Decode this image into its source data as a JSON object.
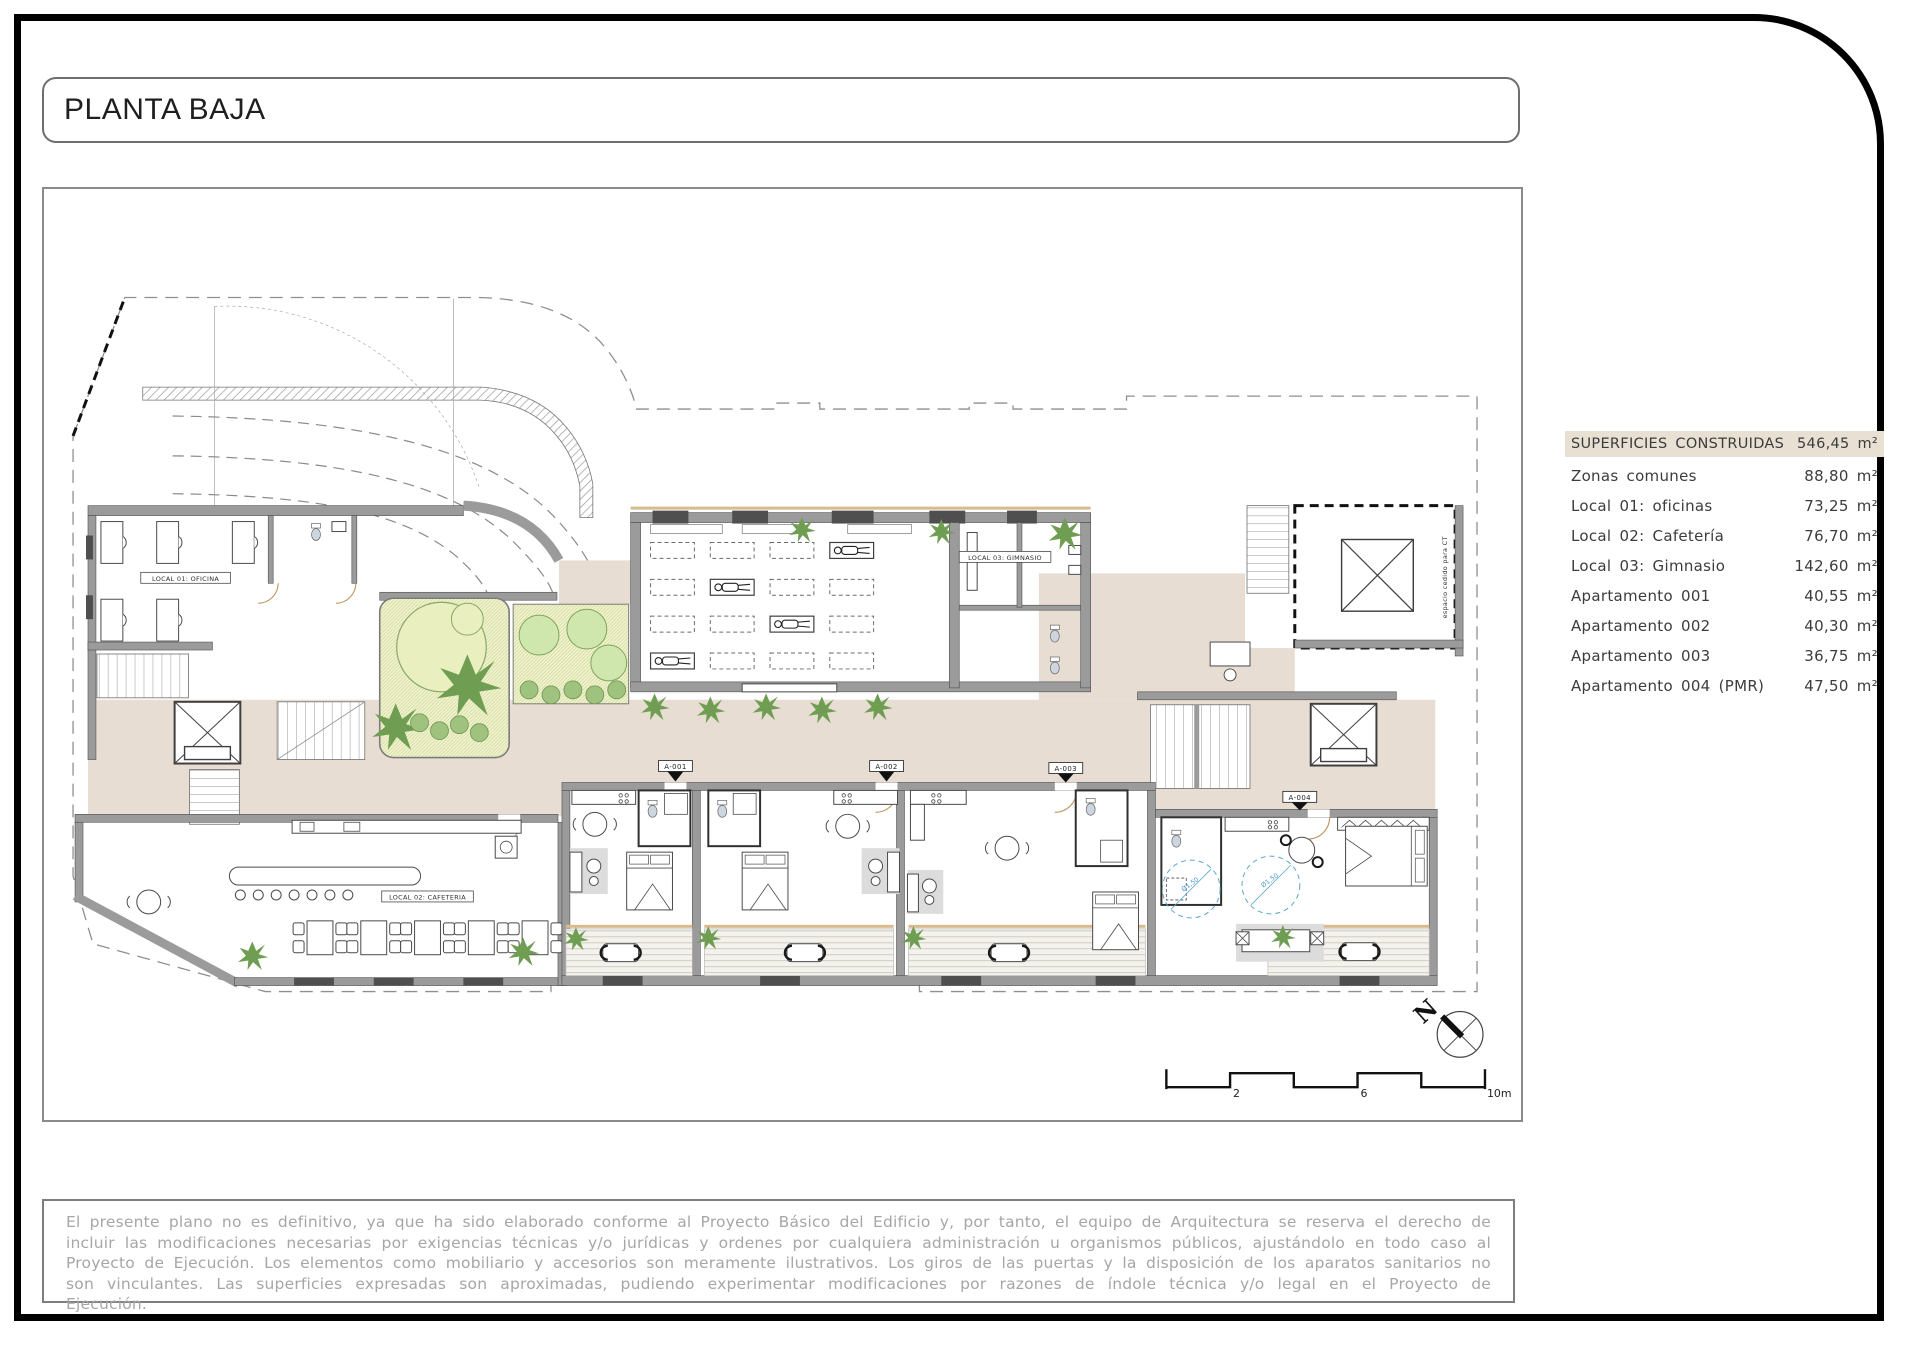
{
  "page": {
    "title": "PLANTA BAJA"
  },
  "areas_table": {
    "header": {
      "label": "SUPERFICIES CONSTRUIDAS",
      "value": "546,45 m²"
    },
    "rows": [
      {
        "label": "Zonas comunes",
        "value": "88,80 m²"
      },
      {
        "label": "Local 01: oficinas",
        "value": "73,25 m²"
      },
      {
        "label": "Local 02: Cafetería",
        "value": "76,70 m²"
      },
      {
        "label": "Local 03: Gimnasio",
        "value": "142,60 m²"
      },
      {
        "label": "Apartamento 001",
        "value": "40,55 m²"
      },
      {
        "label": "Apartamento 002",
        "value": "40,30 m²"
      },
      {
        "label": "Apartamento 003",
        "value": "36,75 m²"
      },
      {
        "label": "Apartamento 004 (PMR)",
        "value": "47,50 m²"
      }
    ]
  },
  "plan": {
    "labels": {
      "local01": "LOCAL 01: OFICINA",
      "local02": "LOCAL 02: CAFETERIA",
      "local03": "LOCAL 03: GIMNASIO",
      "apt1": "A-001",
      "apt2": "A-002",
      "apt3": "A-003",
      "apt4": "A-004",
      "ct": "espacio cedido para CT",
      "turning_circle": "Ø1,50",
      "north": "N"
    },
    "scale_bar": {
      "tick2": "2",
      "tick6": "6",
      "tick10": "10m"
    }
  },
  "disclaimer": "El presente plano no es definitivo, ya que ha sido elaborado conforme al Proyecto Básico del Edificio y, por tanto, el equipo de Arquitectura se reserva el derecho de incluir las modificaciones necesarias por exigencias técnicas y/o jurídicas y ordenes por cualquiera administración u organismos públicos, ajustándolo en todo caso al Proyecto de Ejecución. Los elementos como mobiliario y accesorios son meramente ilustrativos. Los giros de las puertas y la disposición de los aparatos sanitarios no son vinculantes. Las superficies expresadas son aproximadas, pudiendo experimentar modificaciones por razones de índole técnica y/o legal en el Proyecto de Ejecución.",
  "colors": {
    "corridor_beige": "#e7ddd2",
    "table_header_beige": "#e8e0d3",
    "wall_gray": "#9b9b9b",
    "garden_green": "#f1f3d4",
    "plant_green": "#6f9e53",
    "accessible_blue": "#5aa7cc"
  }
}
